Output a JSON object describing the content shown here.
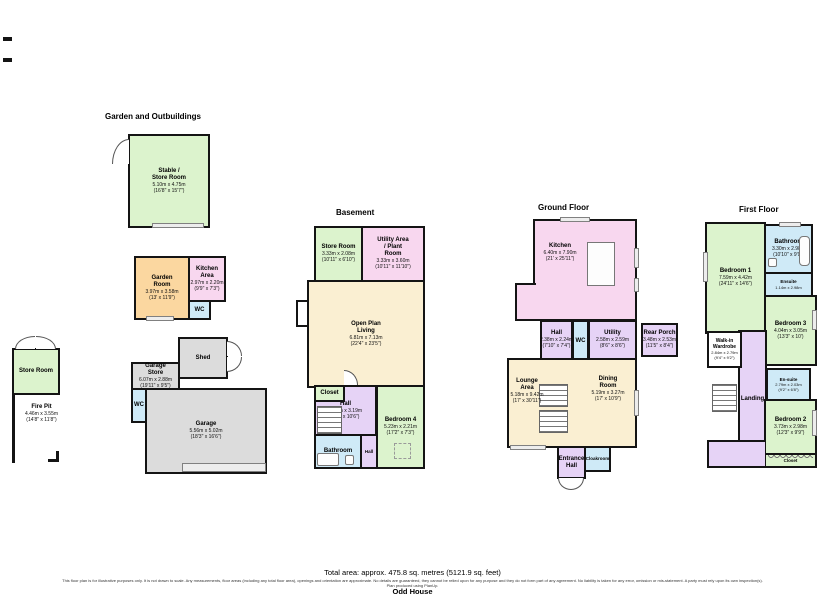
{
  "sections": {
    "garden": {
      "title": "Garden and Outbuildings",
      "rooms": {
        "stable": {
          "name": "Stable / Store Room",
          "metric": "5.10m x 4.75m",
          "imperial": "(16'8\" x 15'7\")"
        },
        "garden_room": {
          "name": "Garden Room",
          "metric": "3.97m x 3.58m",
          "imperial": "(13' x 11'9\")"
        },
        "kitchen_area": {
          "name": "Kitchen Area",
          "metric": "2.97m x 2.20m",
          "imperial": "(9'9\" x 7'3\")"
        },
        "wc_garden": {
          "name": "WC"
        },
        "store_room": {
          "name": "Store Room"
        },
        "fire_pit": {
          "name": "Fire Pit",
          "metric": "4.46m x 3.55m",
          "imperial": "(14'8\" x 11'8\")"
        },
        "shed": {
          "name": "Shed"
        },
        "garage_store": {
          "name": "Garage Store",
          "metric": "6.07m x 2.88m",
          "imperial": "(19'11\" x 9'5\")"
        },
        "wc_garage": {
          "name": "WC"
        },
        "garage": {
          "name": "Garage",
          "metric": "5.56m x 5.02m",
          "imperial": "(18'3\" x 16'6\")"
        }
      }
    },
    "basement": {
      "title": "Basement",
      "rooms": {
        "store_room": {
          "name": "Store Room",
          "metric": "3.33m x 2.08m",
          "imperial": "(10'11\" x 6'10\")"
        },
        "utility_plant": {
          "name": "Utility Area / Plant Room",
          "metric": "3.33m x 3.60m",
          "imperial": "(10'11\" x 11'10\")"
        },
        "open_plan": {
          "name": "Open Plan Living",
          "metric": "6.81m x 7.13m",
          "imperial": "(22'4\" x 23'5\")"
        },
        "closet": {
          "name": "Closet"
        },
        "hall": {
          "name": "Hall",
          "metric": "2.82m x 3.19m",
          "imperial": "(9'3\" x 10'6\")"
        },
        "bedroom4": {
          "name": "Bedroom 4",
          "metric": "5.23m x 2.21m",
          "imperial": "(17'2\" x 7'3\")"
        },
        "bathroom": {
          "name": "Bathroom"
        },
        "hall2": {
          "name": "Hall"
        }
      }
    },
    "ground": {
      "title": "Ground Floor",
      "rooms": {
        "kitchen": {
          "name": "Kitchen",
          "metric": "6.40m x 7.90m",
          "imperial": "(21' x 25'11\")"
        },
        "hall": {
          "name": "Hall",
          "metric": "2.38m x 2.24m",
          "imperial": "(7'10\" x 7'4\")"
        },
        "wc": {
          "name": "WC"
        },
        "utility": {
          "name": "Utility",
          "metric": "2.58m x 2.59m",
          "imperial": "(8'6\" x 8'6\")"
        },
        "rear_porch": {
          "name": "Rear Porch",
          "metric": "3.48m x 2.53m",
          "imperial": "(11'5\" x 8'4\")"
        },
        "lounge": {
          "name": "Lounge Area",
          "metric": "5.18m x 9.42m",
          "imperial": "(17' x 30'11\")"
        },
        "dining": {
          "name": "Dining Room",
          "metric": "5.19m x 3.27m",
          "imperial": "(17' x 10'9\")"
        },
        "entrance": {
          "name": "Entrance Hall"
        },
        "cloakroom": {
          "name": "Cloakroom"
        }
      }
    },
    "first": {
      "title": "First Floor",
      "rooms": {
        "bedroom1": {
          "name": "Bedroom 1",
          "metric": "7.59m x 4.42m",
          "imperial": "(24'11\" x 14'6\")"
        },
        "bathroom": {
          "name": "Bathroom",
          "metric": "3.30m x 2.98m",
          "imperial": "(10'10\" x 9'9\")"
        },
        "ensuite1": {
          "name": "Ensuite",
          "metric": "1.14m x 2.98m",
          "imperial": "(3'9\" x 9'9\")"
        },
        "bedroom3": {
          "name": "Bedroom 3",
          "metric": "4.04m x 3.05m",
          "imperial": "(13'3\" x 10')"
        },
        "walkin": {
          "name": "Walk-in Wardrobe",
          "metric": "2.84m x 2.79m",
          "imperial": "(9'4\" x 9'2\")"
        },
        "landing": {
          "name": "Landing"
        },
        "ensuite2": {
          "name": "En-suite",
          "metric": "2.79m x 2.03m",
          "imperial": "(9'2\" x 6'8\")"
        },
        "bedroom2": {
          "name": "Bedroom 2",
          "metric": "3.73m x 2.98m",
          "imperial": "(12'3\" x 9'9\")"
        },
        "closet": {
          "name": "Closet"
        }
      }
    }
  },
  "footer": {
    "total_area": "Total area: approx. 475.8 sq. metres (5121.9 sq. feet)",
    "disclaimer": "This floor plan is for illustrative purposes only. It is not drawn to scale. Any measurements, floor areas (including any total floor area), openings and orientation are approximate. No details are guaranteed, they cannot be relied upon for any purpose and they do not form part of any agreement. No liability is taken for any error, omission or mis-statement. A party must rely upon its own inspection(s).",
    "produced": "Plan produced using PlanUp.",
    "house_name": "Odd House"
  },
  "colors": {
    "room_green": "#dcf3cd",
    "room_orange": "#fbd7a0",
    "room_pink": "#f8d7ef",
    "room_purple": "#e6d3f6",
    "room_blue": "#cfeaf7",
    "room_cream": "#faefd2",
    "room_gray": "#dcdcdc",
    "wall": "#141414"
  }
}
